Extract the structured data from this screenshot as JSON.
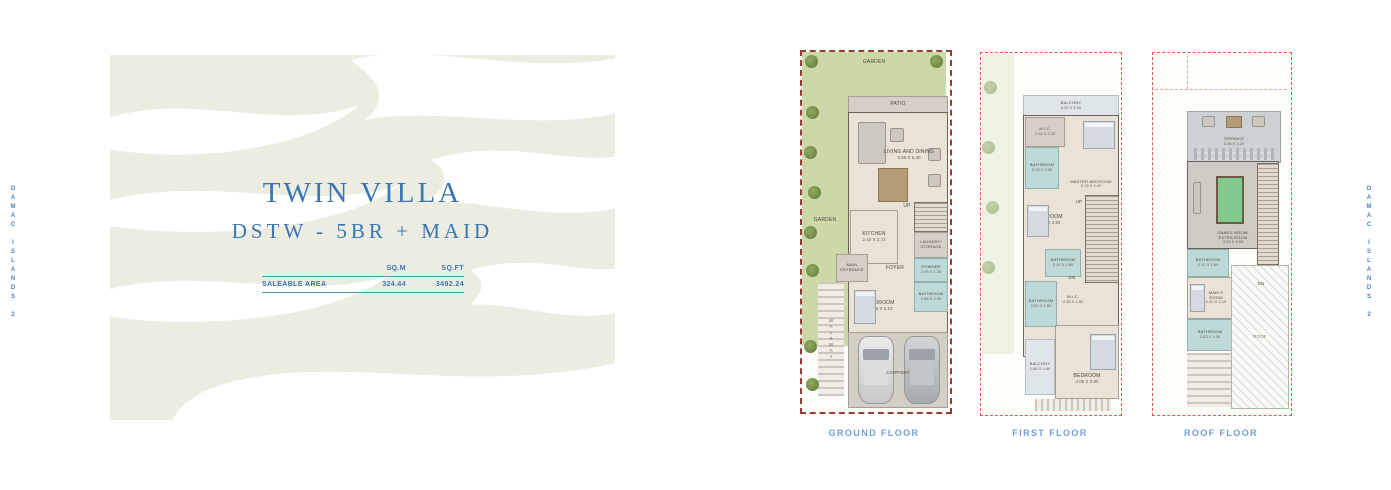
{
  "brand": {
    "side_text_left": "DAMAC ISLANDS 2",
    "side_text_right": "DAMAC ISLANDS 2"
  },
  "panel": {
    "title": "TWIN VILLA",
    "subtitle": "DSTW - 5BR + MAID",
    "area_table": {
      "headers": {
        "sqm": "SQ.M",
        "sqft": "SQ.FT"
      },
      "row": {
        "label": "SALEABLE AREA",
        "sqm": "324.44",
        "sqft": "3492.24"
      }
    }
  },
  "floors": [
    {
      "caption": "GROUND FLOOR",
      "rooms": {
        "garden_top": {
          "label": "GARDEN"
        },
        "garden_left": {
          "label": "GARDEN"
        },
        "patio": {
          "label": "PATIO"
        },
        "living_dining": {
          "label": "LIVING AND DINING",
          "dims": "5.89 X 6.30"
        },
        "kitchen": {
          "label": "KITCHEN",
          "dims": "2.40 X 3.73"
        },
        "stairs": {
          "label": "UP"
        },
        "laundry": {
          "label": "LAUNDRY/ STORAGE"
        },
        "foyer": {
          "label": "FOYER"
        },
        "powder": {
          "label": "POWDER",
          "dims": "2.05 X 1.35"
        },
        "bathroom": {
          "label": "BATHROOM",
          "dims": "1.98 X 2.59"
        },
        "bedroom": {
          "label": "BEDROOM",
          "dims": "3.95 X 3.10"
        },
        "main_entrance": {
          "label": "MAIN ENTRANCE"
        },
        "walkway": {
          "label": "WALKWAY"
        },
        "carport": {
          "label": "CARPORT"
        }
      }
    },
    {
      "caption": "FIRST FLOOR",
      "rooms": {
        "balcony_top": {
          "label": "BALCONY",
          "dims": "5.30 X 1.26"
        },
        "wic_master": {
          "label": "W.I.C.",
          "dims": "2.05 X 2.40"
        },
        "bathroom_master": {
          "label": "BATHROOM",
          "dims": "2.15 X 2.85"
        },
        "master_bedroom": {
          "label": "MASTER BEDROOM",
          "dims": "5.15 X 4.40"
        },
        "bedroom_2": {
          "label": "BEDROOM",
          "dims": "3.50 X 3.84"
        },
        "bathroom_2": {
          "label": "BATHROOM",
          "dims": "2.10 X 1.80"
        },
        "stairs_up": {
          "label": "UP"
        },
        "stairs_dn": {
          "label": "DN"
        },
        "wic_2": {
          "label": "W.I.C.",
          "dims": "4.38 X 1.80"
        },
        "bathroom_3": {
          "label": "BATHROOM",
          "dims": "2.50 X 1.60"
        },
        "balcony_side": {
          "label": "BALCONY",
          "dims": "1.66 X 4.80"
        },
        "bedroom_3": {
          "label": "BEDROOM",
          "dims": "4.05 X 3.90"
        }
      }
    },
    {
      "caption": "ROOF FLOOR",
      "rooms": {
        "terrace": {
          "label": "TERRACE",
          "dims": "5.98 X 3.29"
        },
        "games_room": {
          "label": "GAMES ROOM/ EXTRA ROOM",
          "dims": "4.93 X 4.63"
        },
        "bathroom_4": {
          "label": "BATHROOM",
          "dims": "2.10 X 1.60"
        },
        "maids_room": {
          "label": "MAID'S ROOM",
          "dims": "2.50 X 2.15"
        },
        "stairs_dn": {
          "label": "DN"
        },
        "bathroom_5": {
          "label": "BATHROOM",
          "dims": "2.63 X 1.30"
        },
        "roof": {
          "label": "ROOF"
        }
      }
    }
  ],
  "colors": {
    "title_blue": "#3a76b4",
    "caption_blue": "#6f9fd8",
    "table_line_blue": "#4d9ab5",
    "ground_border_maroon": "#9c3b32",
    "plan_border_red": "#e2574b",
    "garden_green": "#ccd8a8",
    "wet_area_teal": "#bedad8",
    "floor_beige": "#eae2d6",
    "panel_beige": "#ecece3"
  }
}
